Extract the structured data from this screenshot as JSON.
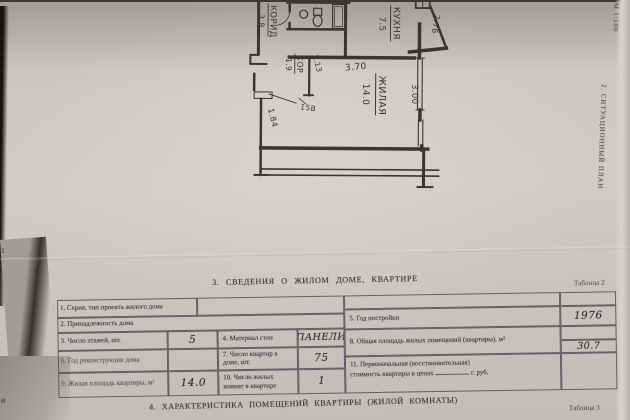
{
  "margin": {
    "scale": "М 1:100",
    "side_title": "2. СИТУАЦИОННЫЙ  ПЛАН"
  },
  "plan": {
    "rooms": {
      "corridor": {
        "label": "КОРИД",
        "area": "3.8"
      },
      "hall": {
        "label": "КОР",
        "area": "1.9"
      },
      "kitchen": {
        "label": "КУХНЯ",
        "area": "7.5"
      },
      "living": {
        "label": "ЖИЛАЯ",
        "area": "14.0"
      }
    },
    "dims": {
      "d276": "2.76",
      "d370": "3.70",
      "d300": "3.00",
      "d113": "1.13",
      "d184": "1.84"
    },
    "closet_mark": "15В"
  },
  "section3": {
    "title": "3. СВЕДЕНИЯ О ЖИЛОМ ДОМЕ,  КВАРТИРЕ",
    "caption": "Таблица 2"
  },
  "table2": {
    "r1": {
      "label": "1. Серия, тип проекта жилого дома",
      "value": ""
    },
    "r2": {
      "label": "2. Принадлежность дома",
      "value": ""
    },
    "r3": {
      "label": "3. Число этажей, шт.",
      "value": "5"
    },
    "r4": {
      "label": "4. Материал стен",
      "value": "ПАНЕЛИ"
    },
    "r5": {
      "label": "5. Год постройки",
      "value": "1976"
    },
    "r6": {
      "label": "6. Год реконструкции дома",
      "value": ""
    },
    "r7": {
      "label": "7. Число квартир в доме, шт.",
      "value": "75"
    },
    "r8": {
      "label": "8. Общая площадь жилых помещений (квартиры), м²",
      "value": "30.7"
    },
    "r9": {
      "label": "9. Жилая площадь квартиры, м²",
      "value": "14.0"
    },
    "r10": {
      "label": "10. Число жилых комнат в квартире",
      "value": "1"
    },
    "r11": {
      "label_line1": "11. Первоначальная (восстановительная)",
      "label_line2": "стоимость квартиры в ценах",
      "suffix": "г. руб.",
      "value": ""
    }
  },
  "section4": {
    "title": "4. ХАРАКТЕРИСТИКА ПОМЕЩЕНИЙ КВАРТИРЫ (ЖИЛОЙ КОМНАТЫ)",
    "caption": "Таблица 3"
  },
  "edge_fragments": {
    "f1": "1",
    "f2": "1 5",
    "f3": "И"
  }
}
